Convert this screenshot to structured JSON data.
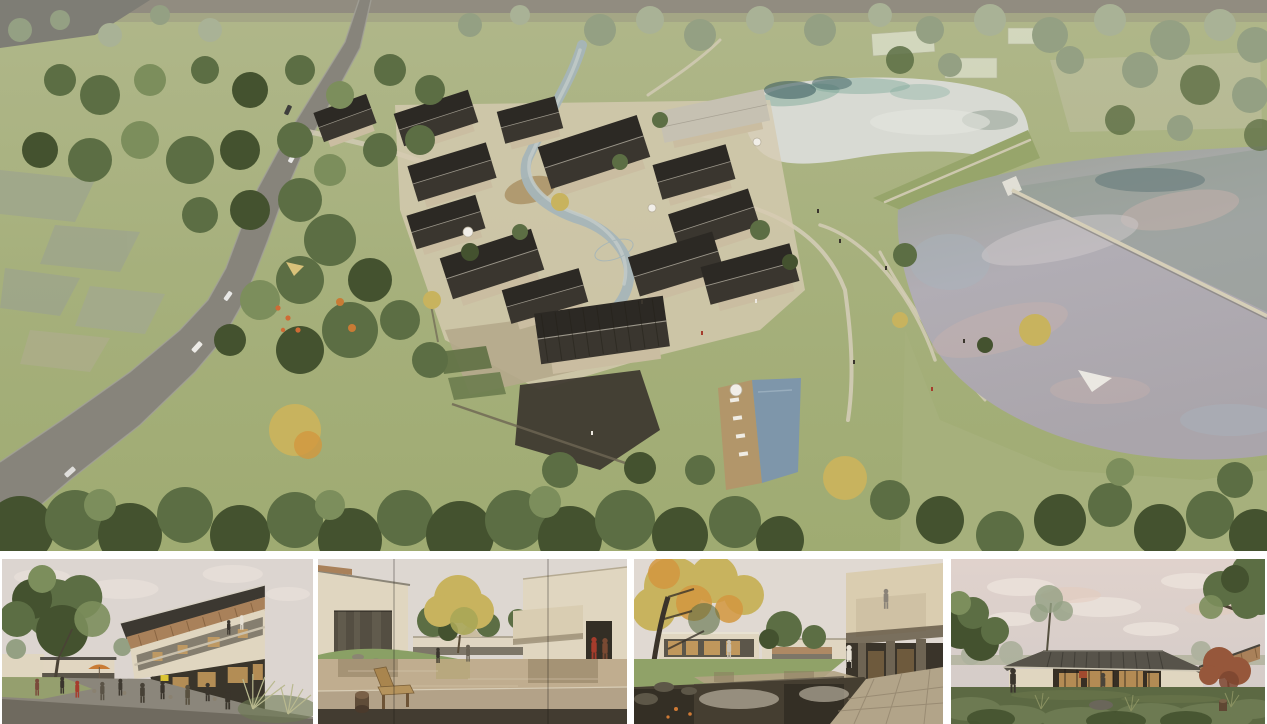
{
  "board": {
    "title": "Architectural rendering presentation board of a courtyard-house village resort",
    "background": "#ffffff"
  },
  "aerial": {
    "label": "Aerial rendering: village of dark-roofed courtyard houses set between a winding country road with woodland on the left and two lakes on the right, with a central stream, clubhouse and swimming pool, grass dam and floating boardwalk",
    "features": [
      "winding country road with cars",
      "dense woodland belt",
      "faded existing field plots",
      "courtyard house cluster with charcoal gabled roofs",
      "central winding stream and ponds",
      "clubhouse with ribbed dark roof",
      "swimming pool with timber deck and loungers",
      "upper pale pond with tree reflections",
      "large lavender-pink lake",
      "grass dam with footpath",
      "floating boardwalk across lake",
      "orange playground and cafe umbrellas",
      "tree canopy band along bottom edge"
    ]
  },
  "panels": [
    {
      "id": "street-cafe",
      "label": "Street-level view: two-storey building with timber-lined sloping roof, outdoor cafe seating under red and orange umbrellas, large tree on the left, grasses in the foreground"
    },
    {
      "id": "reflecting-pond-courtyard",
      "label": "Courtyard view: wooden slat bench and stump stool on a stone deck facing a reflecting pond, tall yellow-green tree, cream buildings and two figures in red walking on the right"
    },
    {
      "id": "waterfall-courtyard",
      "label": "Courtyard view: autumn tree over a dark pond with stone weir and small waterfall, glass pavilion with warm interior light, cantilevered balcony with figure, shaded stone colonnade on the right"
    },
    {
      "id": "dusk-pavilion",
      "label": "Dusk view: low glass pavilion with hipped standing-seam roof and warm lit interior on a lawn, large trees either side, russet maple at right, shrubs and rocks in the foreground"
    }
  ],
  "palette": {
    "paper": "#ffffff",
    "skyWarm": "#dcd5d0",
    "skyDusk": "#e0d2cc",
    "cloud": "#ece3dc",
    "grassTop": "#b2b98c",
    "grass": "#a6b07c",
    "grassDeep": "#97a56b",
    "treeDark": "#44522f",
    "tree": "#5c6e44",
    "treeLight": "#7c8e5c",
    "treeFaded": "#94a083",
    "treePale": "#a9b296",
    "autumn": "#c8b35e",
    "autumnOrange": "#d2973f",
    "road": "#87847b",
    "roadEdge": "#a3a198",
    "roofA": "#3a362f",
    "roofB": "#2c2924",
    "roofPale": "#c6c1b2",
    "ridge": "#9b968a",
    "wall": "#e0d6c0",
    "wallShade": "#cabda1",
    "platform": "#d6cbb1",
    "stone": "#6f6857",
    "stoneDark": "#3f3a30",
    "deckWood": "#b2966a",
    "pool": "#7e96aa",
    "stream": "#a5b5b8",
    "lakePale": "#d8dad3",
    "lakeTeal": "#7fa99a",
    "lakeTealDark": "#3f5f63",
    "lakeLav": "#b1adb4",
    "lakePink": "#c8b2ac",
    "lakeGreen": "#8e9c8f",
    "pathCol": "#d3ccb6",
    "white": "#f1eee8",
    "umbRed": "#b84c2d",
    "umbOrange": "#c97b35",
    "woodSoffit": "#a9815a",
    "glassDark": "#3b362c",
    "interior": "#d2a360",
    "figDark": "#3a352d",
    "figRed": "#a63c2c",
    "pave": "#8b867b",
    "paveDark": "#6f6a5f",
    "pondTan": "#c0ad8f",
    "deckStone": "#b3a288",
    "shadow": "#2f2a22",
    "lawnDusk": "#5c6943",
    "shrub": "#6d7a52"
  }
}
